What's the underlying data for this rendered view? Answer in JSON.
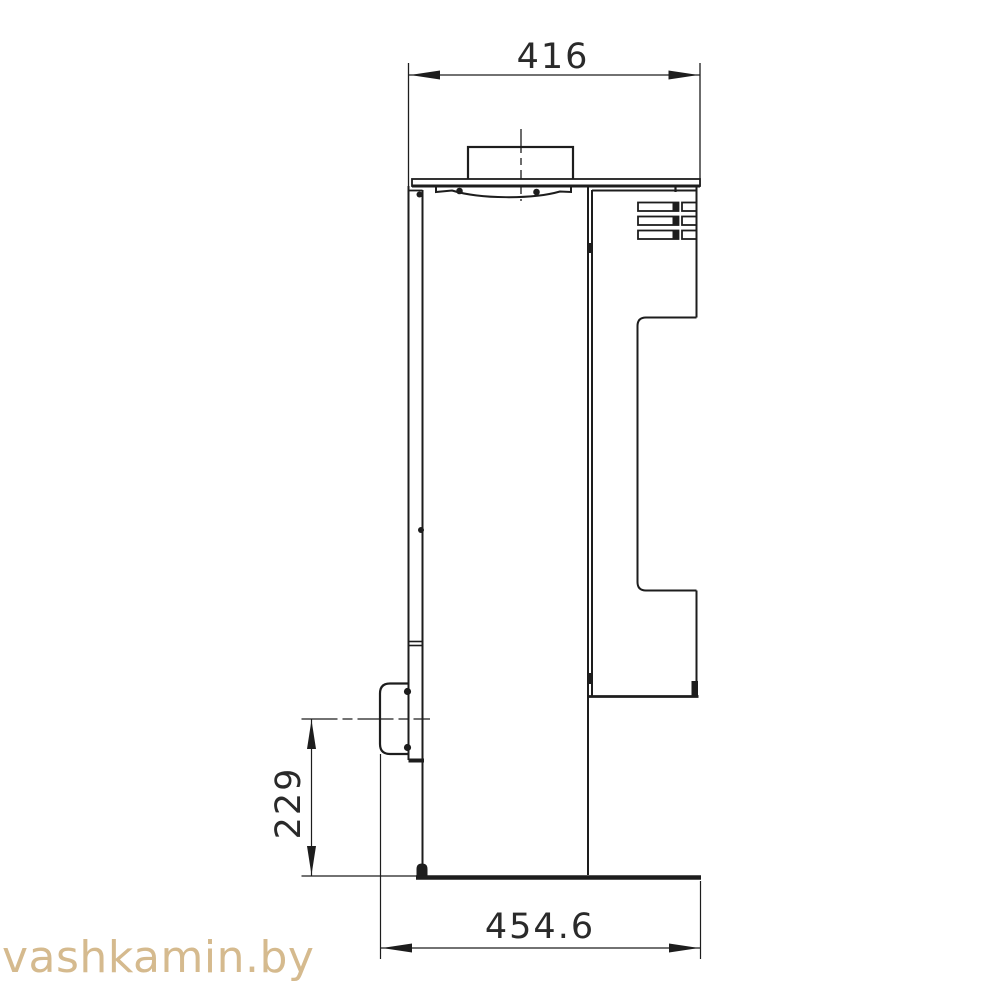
{
  "drawing": {
    "type": "technical side-view drawing of a wood-burning stove with dimension annotations",
    "dimensions": {
      "top_width": "416",
      "handle_height": "229",
      "base_depth": "454.6"
    },
    "watermark": "vashkamin.by",
    "colors": {
      "line": "#1d1d1d",
      "background": "#ffffff",
      "watermark": "#d5ba8e"
    }
  }
}
